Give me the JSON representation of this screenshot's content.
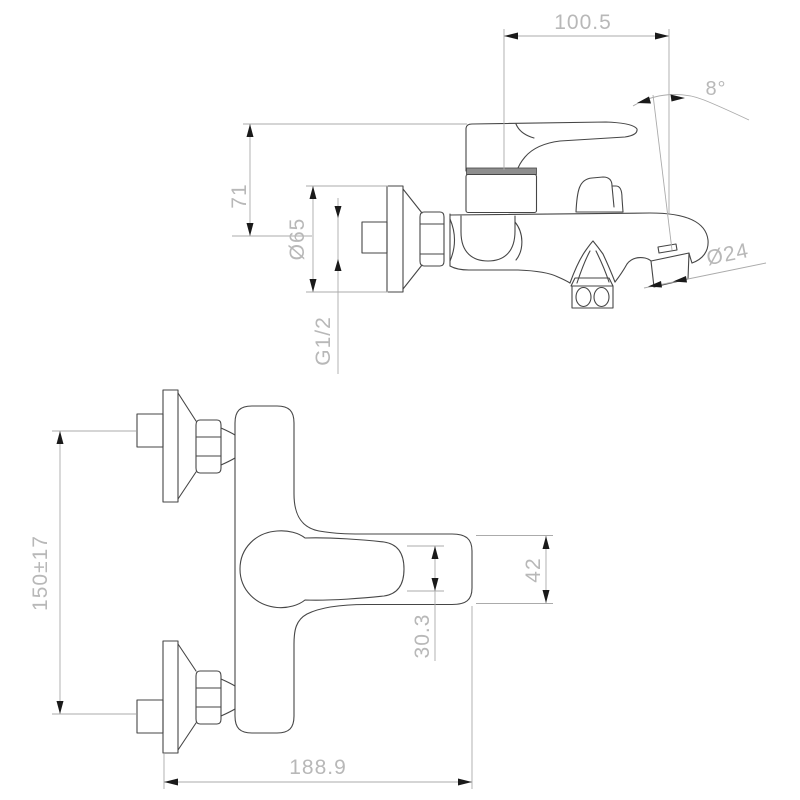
{
  "drawing": {
    "colors": {
      "background": "#ffffff",
      "outline": "#464646",
      "dim_line": "#ababab",
      "dim_text": "#b8b8b8",
      "arrow": "#1a1a1a",
      "collar_fill": "#8e8e8e"
    },
    "side_view": {
      "dimensions": {
        "spout_reach": "100.5",
        "spout_angle": "8°",
        "handle_height": "71",
        "flange_diameter": "Ø65",
        "inlet_thread": "G1/2",
        "spout_diameter": "Ø24"
      }
    },
    "front_view": {
      "dimensions": {
        "inlet_spacing": "150±17",
        "lever_thickness": "30.3",
        "body_width": "42",
        "overall_depth": "188.9"
      }
    }
  }
}
